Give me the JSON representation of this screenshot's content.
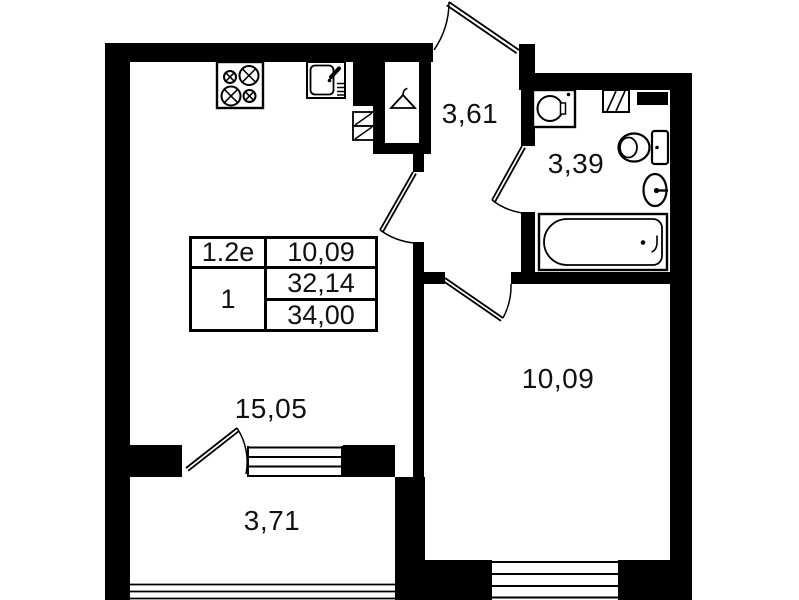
{
  "floor_plan": {
    "colors": {
      "wall": "#000000",
      "background": "#ffffff",
      "text": "#111111"
    },
    "rooms": {
      "hallway": {
        "label": "3,61"
      },
      "bathroom": {
        "label": "3,39"
      },
      "bedroom": {
        "label": "10,09"
      },
      "living_room": {
        "label": "15,05"
      },
      "balcony": {
        "label": "3,71"
      }
    },
    "info_table": {
      "unit_type": "1.2e",
      "living_area": "10,09",
      "room_count": "1",
      "area_excl_balcony": "32,14",
      "total_area": "34,00"
    },
    "fixtures": [
      "stove-icon",
      "kitchen-sink-icon",
      "vent-shaft-hatch",
      "wardrobe-hanger-icon",
      "washing-machine-icon",
      "bathroom-vent-hatch",
      "toilet-icon",
      "washbasin-icon",
      "bathtub-icon"
    ]
  }
}
